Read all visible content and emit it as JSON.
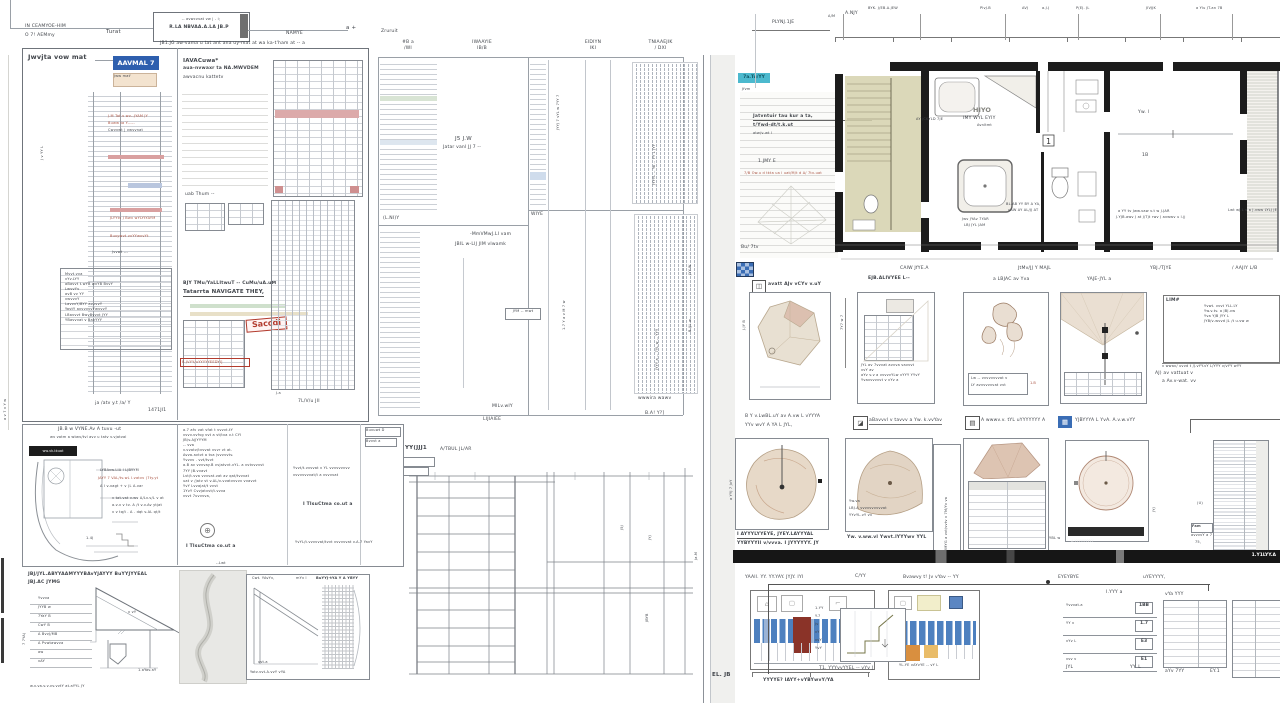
{
  "colors": {
    "accent_blue": "#2e5fae",
    "teal": "#4cb9ce",
    "red": "#b23b2e",
    "pink": "#dcaaaa",
    "beige": "#e8e0d2",
    "rose": "#dcc0b0",
    "olive": "#d5d1ad",
    "tile_blue": "#4d80bf",
    "dark_red": "#8a3328",
    "orange": "#d98f3f",
    "amber": "#e9bc69",
    "wall": "#1c1c1c"
  },
  "header": {
    "left1": "IN CEAMYOE-HIM",
    "left2": "O 7! AEMmy",
    "mid": "Turat",
    "t1": "-- avwcvvat vw | - i;",
    "t2": "R.LA NBVAA.A.LA JB.P",
    "sub": "JB1.JG aw-vama u tat ant ana uy-mat at wa ka-t'ham  at -- a",
    "right": "NAMYE",
    "end": "a +"
  },
  "pa": {
    "title": "Jwvjta vow mat",
    "badge": "AAVMAL 7",
    "bsub": "Jww mat'",
    "n1": "J.M Tat.v wv--JYAM JY",
    "n2": "Buww ta Y-----",
    "n3": "Cwvvwt | vwvvnat",
    "r1": "JLYYtv J Bwv wYLYtYAYM",
    "r2": "Buvywvt vvYYwvvYt",
    "r3": "Jvvwt ---",
    "rows": [
      "Mvvt.vva",
      "vYv.LYY",
      "aBavvt t.wYB wvYB BvvY",
      "LwvvYv",
      "avB vv YY",
      "vwvvvY",
      "LavvvY/BYY avvvvY",
      "YavtY avvvvvvYwvvvY",
      "LBavvvt BwvBvvvt JYY",
      "YBavvvat v BavYYY"
    ],
    "cap": "ja /atv y.t /a/ Y",
    "corner": "1471JI1",
    "rot": "J v YY L"
  },
  "pb": {
    "t1": "IAVACuwa*",
    "t2": "aua-nvwaxr ta NA.MWVDEM",
    "t3": "awvacnu kattetv",
    "mid": "uab Thum --",
    "bt1": "BJY TMu/YaLLItwuT -- CuMu/uA.uM",
    "bt2": "Tatarrta NAVIGATE THEY,",
    "stamp": "Saccdi",
    "red": "B JVYY/uYYYYYEEDYI]",
    "cap": "7L/V/u JII",
    "tick": "J.a"
  },
  "pc": {
    "top": "Zruruit",
    "h1a": "#B a",
    "h1b": "/WI",
    "h2a": "IWAAYIE",
    "h2b": "IB/B",
    "h3a": "EIDIYN",
    "h3b": "IKI",
    "h4a": "TNIAAEJIK",
    "h4b": "/ DXI",
    "f1": "J5 J.W",
    "f2": "Jatar vanl JJ 7 --",
    "f3": "-MmVMwJ.LI vam",
    "f4": "JBIL w-LIJ JIM vlwamk",
    "box": "JYM -- mwt",
    "l1": "(L.NI)Y",
    "l2": "WIYE",
    "b1": "MILv.wIY",
    "b2": "LIJIAIEE",
    "b3": "wwwira wawv",
    "b4": "B.A! Y?]",
    "d1": "JYY-W",
    "d2": "B /JL w",
    "v1": "JYYJ 7 vYL w 7YY 7",
    "v2": "1.7 Y a v M 7 w",
    "v3": "JYYYL -- Ya -- YY L JYY",
    "v4": "JYYY a -- 7YL w -- YYY"
  },
  "arc": {
    "t1": "JB.B w VYNE.Av A tuvu -ut",
    "t2": "wv vatm a wtwv/tvl avv u tatv v.vjatval",
    "black": "ww.vk-tkuat",
    "n1": "LYBAvw.LIA I LJBYYM",
    "n2": "JAYY 7 VAL/tv.wL I.vatvv (7ty.yt",
    "n3": "A I v-vagt + v (L A.var",
    "n4": "v tat.vat v.wv A/Lv.v/L v at",
    "n5": "a.v.v v tv. A /t v.v.Av ytjat",
    "n6": "v v tq/t . A . dqt v.AL qt/t",
    "num": "1.4J"
  },
  "notes": {
    "l": [
      "a.7 afv vat vfat t vvvvt.tY",
      "vvvv.vvfvg vvt a vt/tva v.t CYI",
      "JB/v.AjJYYYM",
      "-- vva",
      "v.vvatv/tvvvat vvvr vt at.",
      "Avva.avtvt a tva jvvvvvtv.",
      "Yvvvv . vvt/tvvt",
      "a.B av vvvvay.B vvjatvvt.vYL. a vvtvvvvvt",
      "7YY JB.vvavt",
      "Lvt/t.vva vvvvat.vat av qat/tvvvat",
      "uat v /jatv vt v.AL/v-vvatvvvvv vvavvt",
      "YvY Lvvajat/t vvvt",
      "1YvY Cvvjatvvt/t.vvva",
      "vvvt 7uvvvva,"
    ],
    "r1": "Yvvt/t.vvvvat v YL vvvvvvvvv",
    "r2": "vvvvvvvvat/t a vvvvvat",
    "r3": "YvYL/t.vvvvvat/tvvt vvvvvvat v.A.7 YavY",
    "bold": "I TIsuCtma co.ut    a",
    "box1": "Buvuwt D",
    "box2": "Bvvvt a"
  },
  "roof": {
    "t1": "JBJ/JYL.ABYYAAMYYYBAvYJAYYY BuYYJYYEAL",
    "t2": "JBJ.AC JYMG",
    "lab": [
      "Yvvva",
      "JYYB w",
      "7YaY B",
      "CwY B",
      "A BvvJ/MB",
      "A Pvwtawvva",
      "aw",
      "vAY"
    ],
    "tri": "v vY",
    "tbl": "1.aYav.aY",
    "bot": "w.v.va.v.v.vv.vvtY at.aYYL JY",
    "rot": "7 7YA)"
  },
  "sk": {
    "top": "--Lwt"
  },
  "hat": {
    "h1": "Cwt. YAvYv,",
    "h2": "mYv l",
    "h3": "BuYYJ-tYA Y A YBYY",
    "cap": "Yatv.vvt.A.vvY vYA",
    "sub": "vvt.a"
  },
  "fr": {
    "t1": "YY(JJJ1",
    "t2": "A/TBUL JL/AR",
    "m1": "J5J",
    "m2": "JYJ",
    "m3": "JBYB",
    "m4": "Ja.M"
  },
  "rs": {
    "badge": "7a.Tu/YY",
    "jf": "Jfvm",
    "nt1": "Jatvntuir tau kur a ta,",
    "nt2": "t/Ywd-dt/t.k.ut",
    "nt3": "atw/v-wt l",
    "mid": "1.JMY E",
    "red": "7/B Ow.u d tkta ua l uat/M/t d A/ 7tv-uat",
    "bot": "Bu/ 7tv",
    "pl": "PLYNJ.1JE",
    "am": "A/M",
    "anjy": "A.NJY",
    "dims": [
      "BYK. J/EB.A.JEW",
      "PlvJ.B",
      "AVJ",
      "a.J.J",
      "P(EJ. JL",
      "JIVJJK",
      "a Ylu JT.an 7B"
    ],
    "und": [
      "CAIW JfYE.A",
      "JtMv/JJ Y MAJL",
      "YBJ./TJYE",
      "/ AAJIY L/B"
    ],
    "plan": {
      "r1": "HIYO",
      "r2": "IMY WYL EYIY",
      "r3": "Avnltmt",
      "bath": "AY /CKYLD 7JE",
      "sh1": "Jwv JYAv 7YAR",
      "sh2": "LBJ JYL JAM",
      "wc1": "BL.AB YY BY A YA,",
      "wc2": "uAW AY AL/JJ AT",
      "one": "1",
      "c1": "Yw. l",
      "c2": "1B",
      "br1": "a YY tv Jww.vaw v.t w J.JAR",
      "br2": "J.YJB.awv J at J/Tjt rwv J avwwv u l.jj",
      "rn": "Lwt wJ.L v a J.vww LYLJ JE"
    },
    "cap0": "avatt AJv vCYv v.uY",
    "cap1": "EJB.ALIVYEE L--",
    "cap2": "a LBJAC av  Yva",
    "cap3": "YAJE-JYL a",
    "v1": "J.JY B",
    "v2": "7Y7 w 7",
    "v3": "a YYJ 7 JvY",
    "p2": [
      "JYL av 7vvvat avvva vavvvt",
      "vvY av",
      "aYv v.v a vvvvvYLw vYYY YYvY",
      "Yvavvvvvvt v vYv a"
    ],
    "p3": [
      "Lw -- vvvvvvvvat v",
      "LY avvvvvvvat vvt"
    ],
    "p3r": "1.B",
    "nb": {
      "lab": "LIM#",
      "l1": "Yvwt. vvvt  YLL.LY",
      "l2": "Yw.v.tv. a  JBJ.vw",
      "l3": "Yva YJB JYY L",
      "l4": "JYB/v-wvvd JL /t u.vw w",
      "un": "v wwav/ uvvd  t /J.vYY.vY  L/YYY v/vYY wYY",
      "a1": "AJ)  av vattuat v",
      "a2": "a  Av.v-wat. vv"
    },
    "cr2": [
      "B Y v.LwBL.uY av A.vw L vYYYA",
      "aBavvvl v tavvv a Yw. k.vvYav",
      "A wwwv.v. tYL uYYYYYYY A",
      "YJBYYYA L YvA. A.v.w.vYY",
      "YYv wvY A YA L JYL,"
    ],
    "r2": {
      "c1a": "I AYYYLYYEYE, JYEY.LAYYYAL",
      "c1b": "YYBYYYII v/vvva. I  JYYYYYY. JY",
      "p2n1": "Yw.va",
      "p2n2": "LBJ.A vvvvvvvvvvat",
      "p2n3": "YYvYL.vY vv",
      "c2": "Yw. v.ww.vl Ywvt.lYYYwv YYL",
      "rot": "YMYG a vvt/vvtv v 7M/Yv va",
      "p4bar": "A YYYYYYYYY",
      "lu": "(U)",
      "l75": "75,",
      "fam": "Fam",
      "fcap": "avvvvY a 7",
      "ebl": "YBL w",
      "d320": "JYJ"
    },
    "bar": "1.Y1LYY.A",
    "cr3": [
      "YAAll. YY. YY.YAY. JYJY. IYI",
      "Bvawvy t! Jv vYav -- YY",
      "EYEYBYE",
      "uYEYYYY,"
    ],
    "ti": {
      "cap": "YYYYE? IAYY+vYBYwvY/YA",
      "t2": "YL.YE vAYvYE -- vY L",
      "el": "EL. JB"
    },
    "bt": {
      "cy": "C/YY",
      "s1": [
        "1.YY",
        "Y.7",
        "Jv",
        "vY",
        "vvY",
        "YvY"
      ],
      "s1cap": "T1. YYYvvYYEL -- vYv J",
      "s2h": "I.YYY a",
      "s2": [
        {
          "l": "Yvvvat.a",
          "v": "1BB"
        },
        {
          "l": "YY v",
          "v": "1.7"
        },
        {
          "l": "vYv L",
          "v": "E3"
        },
        {
          "l": "vvv v",
          "v": "E1"
        }
      ],
      "s2f1": "JYL",
      "s2f2": "YY. L",
      "s3h": "vYa YYY",
      "s3f": "aYv 7YY",
      "s3v": "EY.1"
    }
  },
  "misc": {
    "rot": "a v 7 v Y w"
  }
}
